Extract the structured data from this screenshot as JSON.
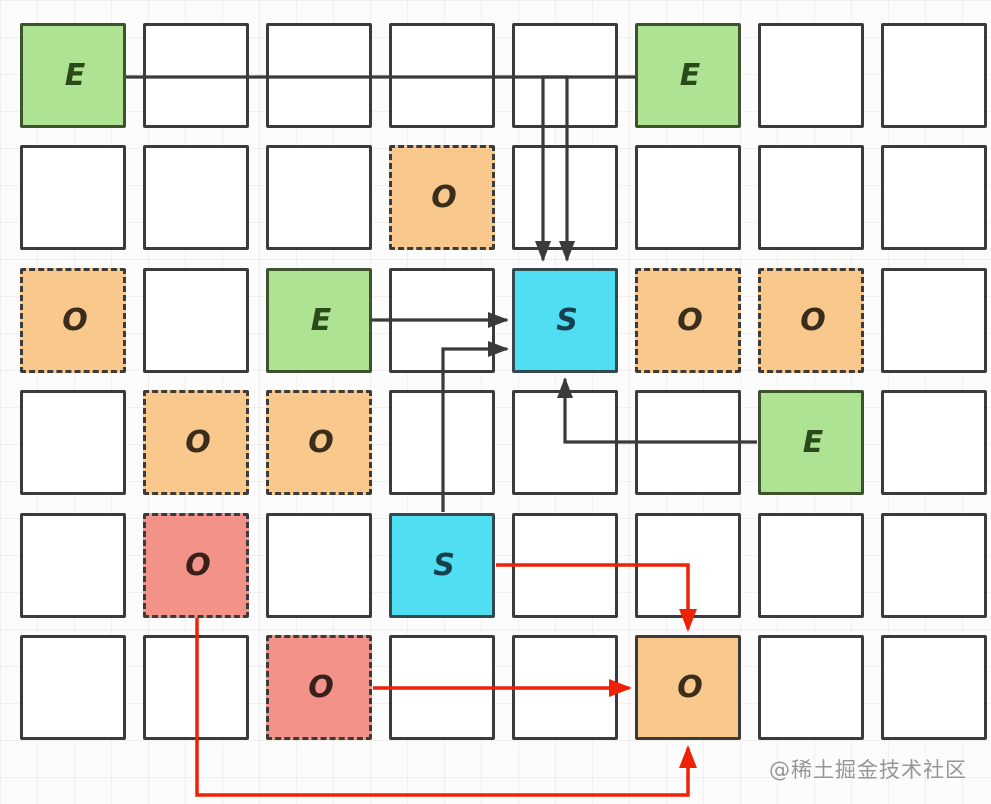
{
  "page": {
    "watermark": "@稀土掘金技术社区"
  },
  "colors": {
    "line_black": "#3a3a3a",
    "line_red": "#ed2207",
    "plain_fill": "#ffffff",
    "box_border": "#3b3b3b",
    "event_fill": "#aee394",
    "event_border": "#3f5230",
    "event_text": "#2b4a1a",
    "subscriber_fill": "#4fdef2",
    "subscriber_border": "#34494e",
    "subscriber_text": "#17404f",
    "observer_fill": "#f8c88c",
    "observer_text": "#3a2d1c",
    "observer_off_fill": "#f29288",
    "observer_off_text": "#38201a"
  },
  "cell_types": {
    "plain": {
      "label": "",
      "fill": "#ffffff",
      "border_color": "#3b3b3b",
      "border_style": "solid",
      "text_color": "#3b3b3b",
      "name": "grid-cell"
    },
    "event": {
      "label": "E",
      "fill": "#aee394",
      "border_color": "#3f5230",
      "border_style": "solid",
      "text_color": "#2b4a1a",
      "name": "event-cell"
    },
    "subscriber": {
      "label": "S",
      "fill": "#4fdef2",
      "border_color": "#34494e",
      "border_style": "solid",
      "text_color": "#17404f",
      "name": "subscriber-cell"
    },
    "observer": {
      "label": "O",
      "fill": "#f8c88c",
      "border_color": "#3b3b3b",
      "border_style": "dashed",
      "text_color": "#3a2d1c",
      "name": "observer-cell"
    },
    "observer_off": {
      "label": "O",
      "fill": "#f29288",
      "border_color": "#3b3b3b",
      "border_style": "dashed",
      "text_color": "#38201a",
      "name": "inactive-observer-cell"
    },
    "observer_target": {
      "label": "O",
      "fill": "#f8c88c",
      "border_color": "#3b3b3b",
      "border_style": "solid",
      "text_color": "#3a2d1c",
      "name": "target-observer-cell"
    }
  },
  "grid": {
    "col_lefts": [
      20,
      143,
      266,
      389,
      512,
      635,
      758,
      881
    ],
    "row_tops": [
      23,
      145,
      268,
      390,
      513,
      635
    ],
    "cell_w": 106,
    "cell_h": 105,
    "rows": [
      [
        "event",
        "plain",
        "plain",
        "plain",
        "plain",
        "event",
        "plain",
        "plain"
      ],
      [
        "plain",
        "plain",
        "plain",
        "observer",
        "plain",
        "plain",
        "plain",
        "plain"
      ],
      [
        "observer",
        "plain",
        "event",
        "plain",
        "subscriber",
        "observer",
        "observer",
        "plain"
      ],
      [
        "plain",
        "observer",
        "observer",
        "plain",
        "plain",
        "plain",
        "event",
        "plain"
      ],
      [
        "plain",
        "observer_off",
        "plain",
        "subscriber",
        "plain",
        "plain",
        "plain",
        "plain"
      ],
      [
        "plain",
        "plain",
        "observer_off",
        "plain",
        "plain",
        "observer_target",
        "plain",
        "plain"
      ]
    ]
  },
  "arrows": [
    {
      "name": "event1-to-subscriber1",
      "color": "black",
      "path": "M126,77 L567,77 L567,260"
    },
    {
      "name": "event2-to-subscriber1",
      "color": "black",
      "path": "M636,77 L543,77 L543,260"
    },
    {
      "name": "event3-to-subscriber1",
      "color": "black",
      "path": "M372,320 L507,320"
    },
    {
      "name": "subscriber2-to-subscriber1",
      "color": "black",
      "path": "M443,512 L443,349 L507,349"
    },
    {
      "name": "event4-to-subscriber1",
      "color": "black",
      "path": "M757,442 L565,442 L565,379"
    },
    {
      "name": "subscriber2-to-target-observer",
      "color": "red",
      "path": "M496,565 L688,565 L688,629"
    },
    {
      "name": "red-observer2-to-target-observer",
      "color": "red",
      "path": "M373,688 L629,688"
    },
    {
      "name": "red-observer1-to-target-observer",
      "color": "red",
      "path": "M197,618 L197,795 L688,795 L688,748"
    }
  ]
}
